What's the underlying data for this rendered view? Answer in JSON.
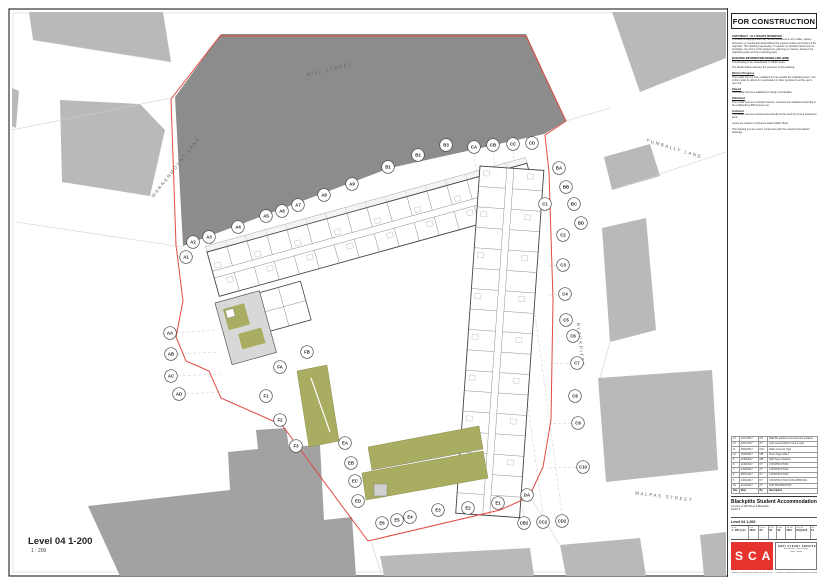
{
  "sheet": {
    "stamp": "FOR CONSTRUCTION",
    "notes": [
      {
        "h": "COPYRIGHT :  ALL RIGHTS RESERVED",
        "b": "This work is copyright and may not be reproduced in any matter, pattern, dimension or mechanical detail without the express written permission of the originator. This drawing supersedes, if required, by specified documents & templates. Any items of this agreement, planning or masters, between the originating party and the instructing party."
      },
      {
        "h": "BUILDING INFORMATION MODELLING (BIM)",
        "b": "This Drawing to be viewed/read in a BIM model."
      },
      {
        "h": "",
        "b": "The Model Status indicates the purposes of this drawing:"
      },
      {
        "h": "Work in Progress",
        "b": "This model has not been validated for use outside the originating team. Use of this model by others for coordination or other purposes is at the user's own risk."
      },
      {
        "h": "Shared",
        "b": "This model has been validated for design coordination."
      },
      {
        "h": "Published",
        "b": "This model has been formally checked, reviewed and validated according to the collaborative BIM process set."
      },
      {
        "h": "Archived",
        "b": "This model has been archived and should not be used for current production work."
      },
      {
        "h": "",
        "b": "Levels are related to Ordnance Datum Malin Head."
      },
      {
        "h": "",
        "b": "This drawing is to be read in conjunction with the relevant Consultants' drawings."
      }
    ],
    "revision_table": {
      "headers": [
        "Rev.",
        "Date",
        "By",
        "Description"
      ],
      "rows": [
        [
          "13",
          "13/12/2017",
          "MT",
          "M&E BC partitions removed and updated"
        ],
        [
          "12",
          "02/11/2017",
          "KT",
          "Light recess 500mm front to wall"
        ],
        [
          "11",
          "29/09/2017",
          "DOL",
          "Walls at interior Tags"
        ],
        [
          "10",
          "15/08/2017",
          "MB",
          "Room Tags Added"
        ],
        [
          "9",
          "11/08/2017",
          "MB",
          "Wall Types Updated"
        ],
        [
          "8",
          "11/08/2017",
          "KT",
          "CONSTRUCTION"
        ],
        [
          "7",
          "04/08/2017",
          "KT",
          "CONSTRUCTION"
        ],
        [
          "6",
          "28/07/2017",
          "KT",
          "CONSTRUCTION"
        ],
        [
          "5",
          "23/06/2017",
          "KT",
          "CONSTRUCTION FOR APPROVAL"
        ],
        [
          "P1",
          "21/04/2017",
          "KT",
          "FOR INFORMATION"
        ]
      ]
    },
    "title_block": {
      "project": "Blackpitts Student Accommodation",
      "address_line1": "Junction of Mill Street & Blackpitts",
      "address_line2": "Dublin 8",
      "drawing_title": "Level 04 1-200",
      "fields": [
        {
          "l": "Scale",
          "v": "1 : 200 @ A1"
        },
        {
          "l": "Date",
          "v": "12/17"
        },
        {
          "l": "Drawn",
          "v": "KT"
        },
        {
          "l": "Chkd",
          "v": "AF"
        },
        {
          "l": "Stage",
          "v": "S4"
        },
        {
          "l": "Job No",
          "v": "1614"
        },
        {
          "l": "Dwg No",
          "v": "PL(0)-104"
        },
        {
          "l": "Rev",
          "v": "13"
        }
      ]
    },
    "logo": {
      "letters": "SCA",
      "architect": "SHAY CLEARY ARCHITECTS",
      "architect_lines": [
        "Architecture + Urban Design",
        "Dublin, Ireland"
      ]
    },
    "footer": "Ordnance Survey Ireland Licence No. AR 0021817  © Ordnance Survey Ireland / Government of Ireland",
    "scale_label": {
      "title": "Level 04 1-200",
      "scale": "1 : 200"
    }
  },
  "plan": {
    "streets": [
      {
        "label": "MILL STREET",
        "x": 330,
        "y": 71,
        "rot": -13
      },
      {
        "label": "WARRENMOUNT LANE",
        "x": 177,
        "y": 168,
        "rot": -52
      },
      {
        "label": "FUMBALLY LANE",
        "x": 674,
        "y": 150,
        "rot": 17
      },
      {
        "label": "BLACKPITTS",
        "x": 579,
        "y": 345,
        "rot": 84
      },
      {
        "label": "MALPAS STREET",
        "x": 664,
        "y": 498,
        "rot": 7
      }
    ],
    "grid_bubbles": [
      {
        "label": "A1",
        "x": 186,
        "y": 257
      },
      {
        "label": "A2",
        "x": 193,
        "y": 242
      },
      {
        "label": "A3",
        "x": 209,
        "y": 237
      },
      {
        "label": "A4",
        "x": 238,
        "y": 227
      },
      {
        "label": "A5",
        "x": 266,
        "y": 216
      },
      {
        "label": "A6",
        "x": 282,
        "y": 211
      },
      {
        "label": "A7",
        "x": 298,
        "y": 205
      },
      {
        "label": "A8",
        "x": 324,
        "y": 195
      },
      {
        "label": "A9",
        "x": 352,
        "y": 184
      },
      {
        "label": "B1",
        "x": 388,
        "y": 167
      },
      {
        "label": "B2",
        "x": 418,
        "y": 155
      },
      {
        "label": "B3",
        "x": 446,
        "y": 145
      },
      {
        "label": "CA",
        "x": 474,
        "y": 147
      },
      {
        "label": "CB",
        "x": 493,
        "y": 145
      },
      {
        "label": "CC",
        "x": 513,
        "y": 144
      },
      {
        "label": "CD",
        "x": 532,
        "y": 143
      },
      {
        "label": "BA",
        "x": 559,
        "y": 168
      },
      {
        "label": "BB",
        "x": 566,
        "y": 187
      },
      {
        "label": "C1",
        "x": 545,
        "y": 204
      },
      {
        "label": "BC",
        "x": 574,
        "y": 204
      },
      {
        "label": "BD",
        "x": 581,
        "y": 223
      },
      {
        "label": "C2",
        "x": 563,
        "y": 235
      },
      {
        "label": "C3",
        "x": 563,
        "y": 265
      },
      {
        "label": "C4",
        "x": 565,
        "y": 294
      },
      {
        "label": "C5",
        "x": 566,
        "y": 320
      },
      {
        "label": "C6",
        "x": 573,
        "y": 336
      },
      {
        "label": "C7",
        "x": 577,
        "y": 363
      },
      {
        "label": "C8",
        "x": 575,
        "y": 396
      },
      {
        "label": "C9",
        "x": 578,
        "y": 423
      },
      {
        "label": "C10",
        "x": 583,
        "y": 467
      },
      {
        "label": "DA",
        "x": 527,
        "y": 495
      },
      {
        "label": "E1",
        "x": 498,
        "y": 503
      },
      {
        "label": "E2",
        "x": 468,
        "y": 508
      },
      {
        "label": "E3",
        "x": 438,
        "y": 510
      },
      {
        "label": "E4",
        "x": 410,
        "y": 517
      },
      {
        "label": "E5",
        "x": 397,
        "y": 520
      },
      {
        "label": "E6",
        "x": 382,
        "y": 523
      },
      {
        "label": "CB2",
        "x": 524,
        "y": 523
      },
      {
        "label": "CC2",
        "x": 543,
        "y": 522
      },
      {
        "label": "CD2",
        "x": 562,
        "y": 521
      },
      {
        "label": "EA",
        "x": 345,
        "y": 443
      },
      {
        "label": "EB",
        "x": 351,
        "y": 463
      },
      {
        "label": "EC",
        "x": 355,
        "y": 481
      },
      {
        "label": "ED",
        "x": 358,
        "y": 501
      },
      {
        "label": "F3",
        "x": 296,
        "y": 446
      },
      {
        "label": "F2",
        "x": 280,
        "y": 420
      },
      {
        "label": "F1",
        "x": 266,
        "y": 396
      },
      {
        "label": "FA",
        "x": 280,
        "y": 367
      },
      {
        "label": "FB",
        "x": 307,
        "y": 352
      },
      {
        "label": "AA",
        "x": 170,
        "y": 333
      },
      {
        "label": "AB",
        "x": 171,
        "y": 354
      },
      {
        "label": "AC",
        "x": 171,
        "y": 376
      },
      {
        "label": "AD",
        "x": 179,
        "y": 394
      }
    ],
    "colors": {
      "site_boundary": "#e04a42",
      "context_dark": "#8c8c8c",
      "context_light": "#b9b9b9",
      "context_mid": "#a2a2a2",
      "roof_green": "#a9ad62",
      "logo_red": "#e6332d"
    }
  }
}
